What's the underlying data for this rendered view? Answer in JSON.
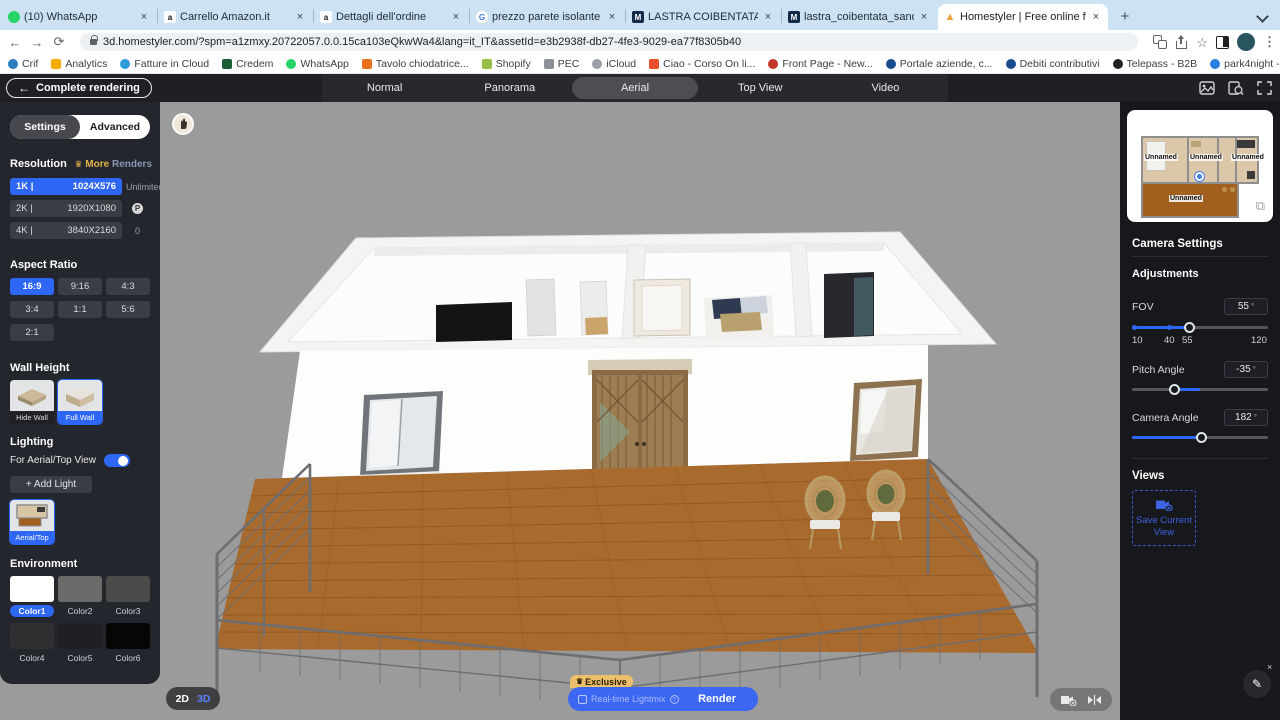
{
  "icons": {
    "close": "×",
    "plus": "+",
    "back_arrow": "←",
    "forward_arrow": "→",
    "reload": "⟳",
    "star": "☆",
    "kebab": "⋮",
    "overflow": "»",
    "copy": "⧉",
    "crown": "♛",
    "pencil": "✎",
    "question": "?",
    "degree": "°"
  },
  "browser": {
    "tabs": [
      {
        "label": "(10) WhatsApp"
      },
      {
        "label": "Carrello Amazon.it"
      },
      {
        "label": "Dettagli dell'ordine"
      },
      {
        "label": "prezzo parete isolante sandwic"
      },
      {
        "label": "LASTRA COIBENTATA SANDWI"
      },
      {
        "label": "lastra_coibentata_sandwich_m"
      },
      {
        "label": "Homestyler | Free online floor"
      }
    ],
    "url": "3d.homestyler.com/?spm=a1zmxy.20722057.0.0.15ca103eQkwWa4&lang=it_IT&assetId=e3b2938f-db27-4fe3-9029-ea77f8305b40",
    "bookmarks": [
      {
        "label": "Crif"
      },
      {
        "label": "Analytics"
      },
      {
        "label": "Fatture in Cloud"
      },
      {
        "label": "Credem"
      },
      {
        "label": "WhatsApp"
      },
      {
        "label": "Tavolo chiodatrice..."
      },
      {
        "label": "Shopify"
      },
      {
        "label": "PEC"
      },
      {
        "label": "iCloud"
      },
      {
        "label": "Ciao - Corso On li..."
      },
      {
        "label": "Front Page - New..."
      },
      {
        "label": "Portale aziende, c..."
      },
      {
        "label": "Debiti contributivi"
      },
      {
        "label": "Telepass - B2B"
      },
      {
        "label": "park4night - Luoghi"
      },
      {
        "label": "Generatore gratuit..."
      }
    ]
  },
  "toolbar": {
    "back_label": "Complete rendering",
    "modes": [
      {
        "label": "Normal"
      },
      {
        "label": "Panorama"
      },
      {
        "label": "Aerial"
      },
      {
        "label": "Top View"
      },
      {
        "label": "Video"
      }
    ]
  },
  "sidebar": {
    "tabs": {
      "settings": "Settings",
      "advanced": "Advanced"
    },
    "resolution": {
      "title": "Resolution",
      "more": "More",
      "renders": "Renders",
      "options": [
        {
          "k": "1K |",
          "v": "1024X576"
        },
        {
          "k": "2K |",
          "v": "1920X1080"
        },
        {
          "k": "4K |",
          "v": "3840X2160"
        }
      ],
      "unlimited": "Unlimited",
      "coin": "P",
      "zero": "0"
    },
    "aspect": {
      "title": "Aspect Ratio",
      "options": [
        {
          "label": "16:9"
        },
        {
          "label": "9:16"
        },
        {
          "label": "4:3"
        },
        {
          "label": "3:4"
        },
        {
          "label": "1:1"
        },
        {
          "label": "5:6"
        },
        {
          "label": "2:1"
        }
      ]
    },
    "wall": {
      "title": "Wall Height",
      "hide": "Hide Wall",
      "full": "Full Wall"
    },
    "lighting": {
      "title": "Lighting",
      "toggle_label": "For Aerial/Top View",
      "add": "+ Add Light",
      "thumb": "Aerial/Top"
    },
    "environment": {
      "title": "Environment",
      "colors": [
        {
          "label": "Color1",
          "hex": "#ffffff"
        },
        {
          "label": "Color2",
          "hex": "#6a6a6a"
        },
        {
          "label": "Color3",
          "hex": "#4b4b4b"
        },
        {
          "label": "Color4",
          "hex": "#2f3032"
        },
        {
          "label": "Color5",
          "hex": "#1f2023"
        },
        {
          "label": "Color6",
          "hex": "#060606"
        }
      ]
    }
  },
  "camera": {
    "title": "Camera Settings",
    "adjustments": "Adjustments",
    "fov": {
      "label": "FOV",
      "value": "55",
      "ticks": [
        "10",
        "40",
        "55",
        "120"
      ]
    },
    "pitch": {
      "label": "Pitch Angle",
      "value": "-35"
    },
    "angle": {
      "label": "Camera Angle",
      "value": "182"
    },
    "views": {
      "title": "Views",
      "save": "Save Current View"
    }
  },
  "minimap": {
    "rooms": [
      "Unnamed",
      "Unnamed",
      "Unnamed"
    ],
    "deck": "Unnamed"
  },
  "bottom": {
    "d2": "2D",
    "d3": "3D",
    "exclusive": "Exclusive",
    "lightmix": "Real-time Lightmix",
    "render": "Render"
  },
  "colors": {
    "accent_blue": "#2e66f5",
    "render_blue": "#3c67f2",
    "gold": "#e3b34c",
    "deck_brown": "#a96a2e",
    "canvas_gray": "#9b9b9c"
  }
}
